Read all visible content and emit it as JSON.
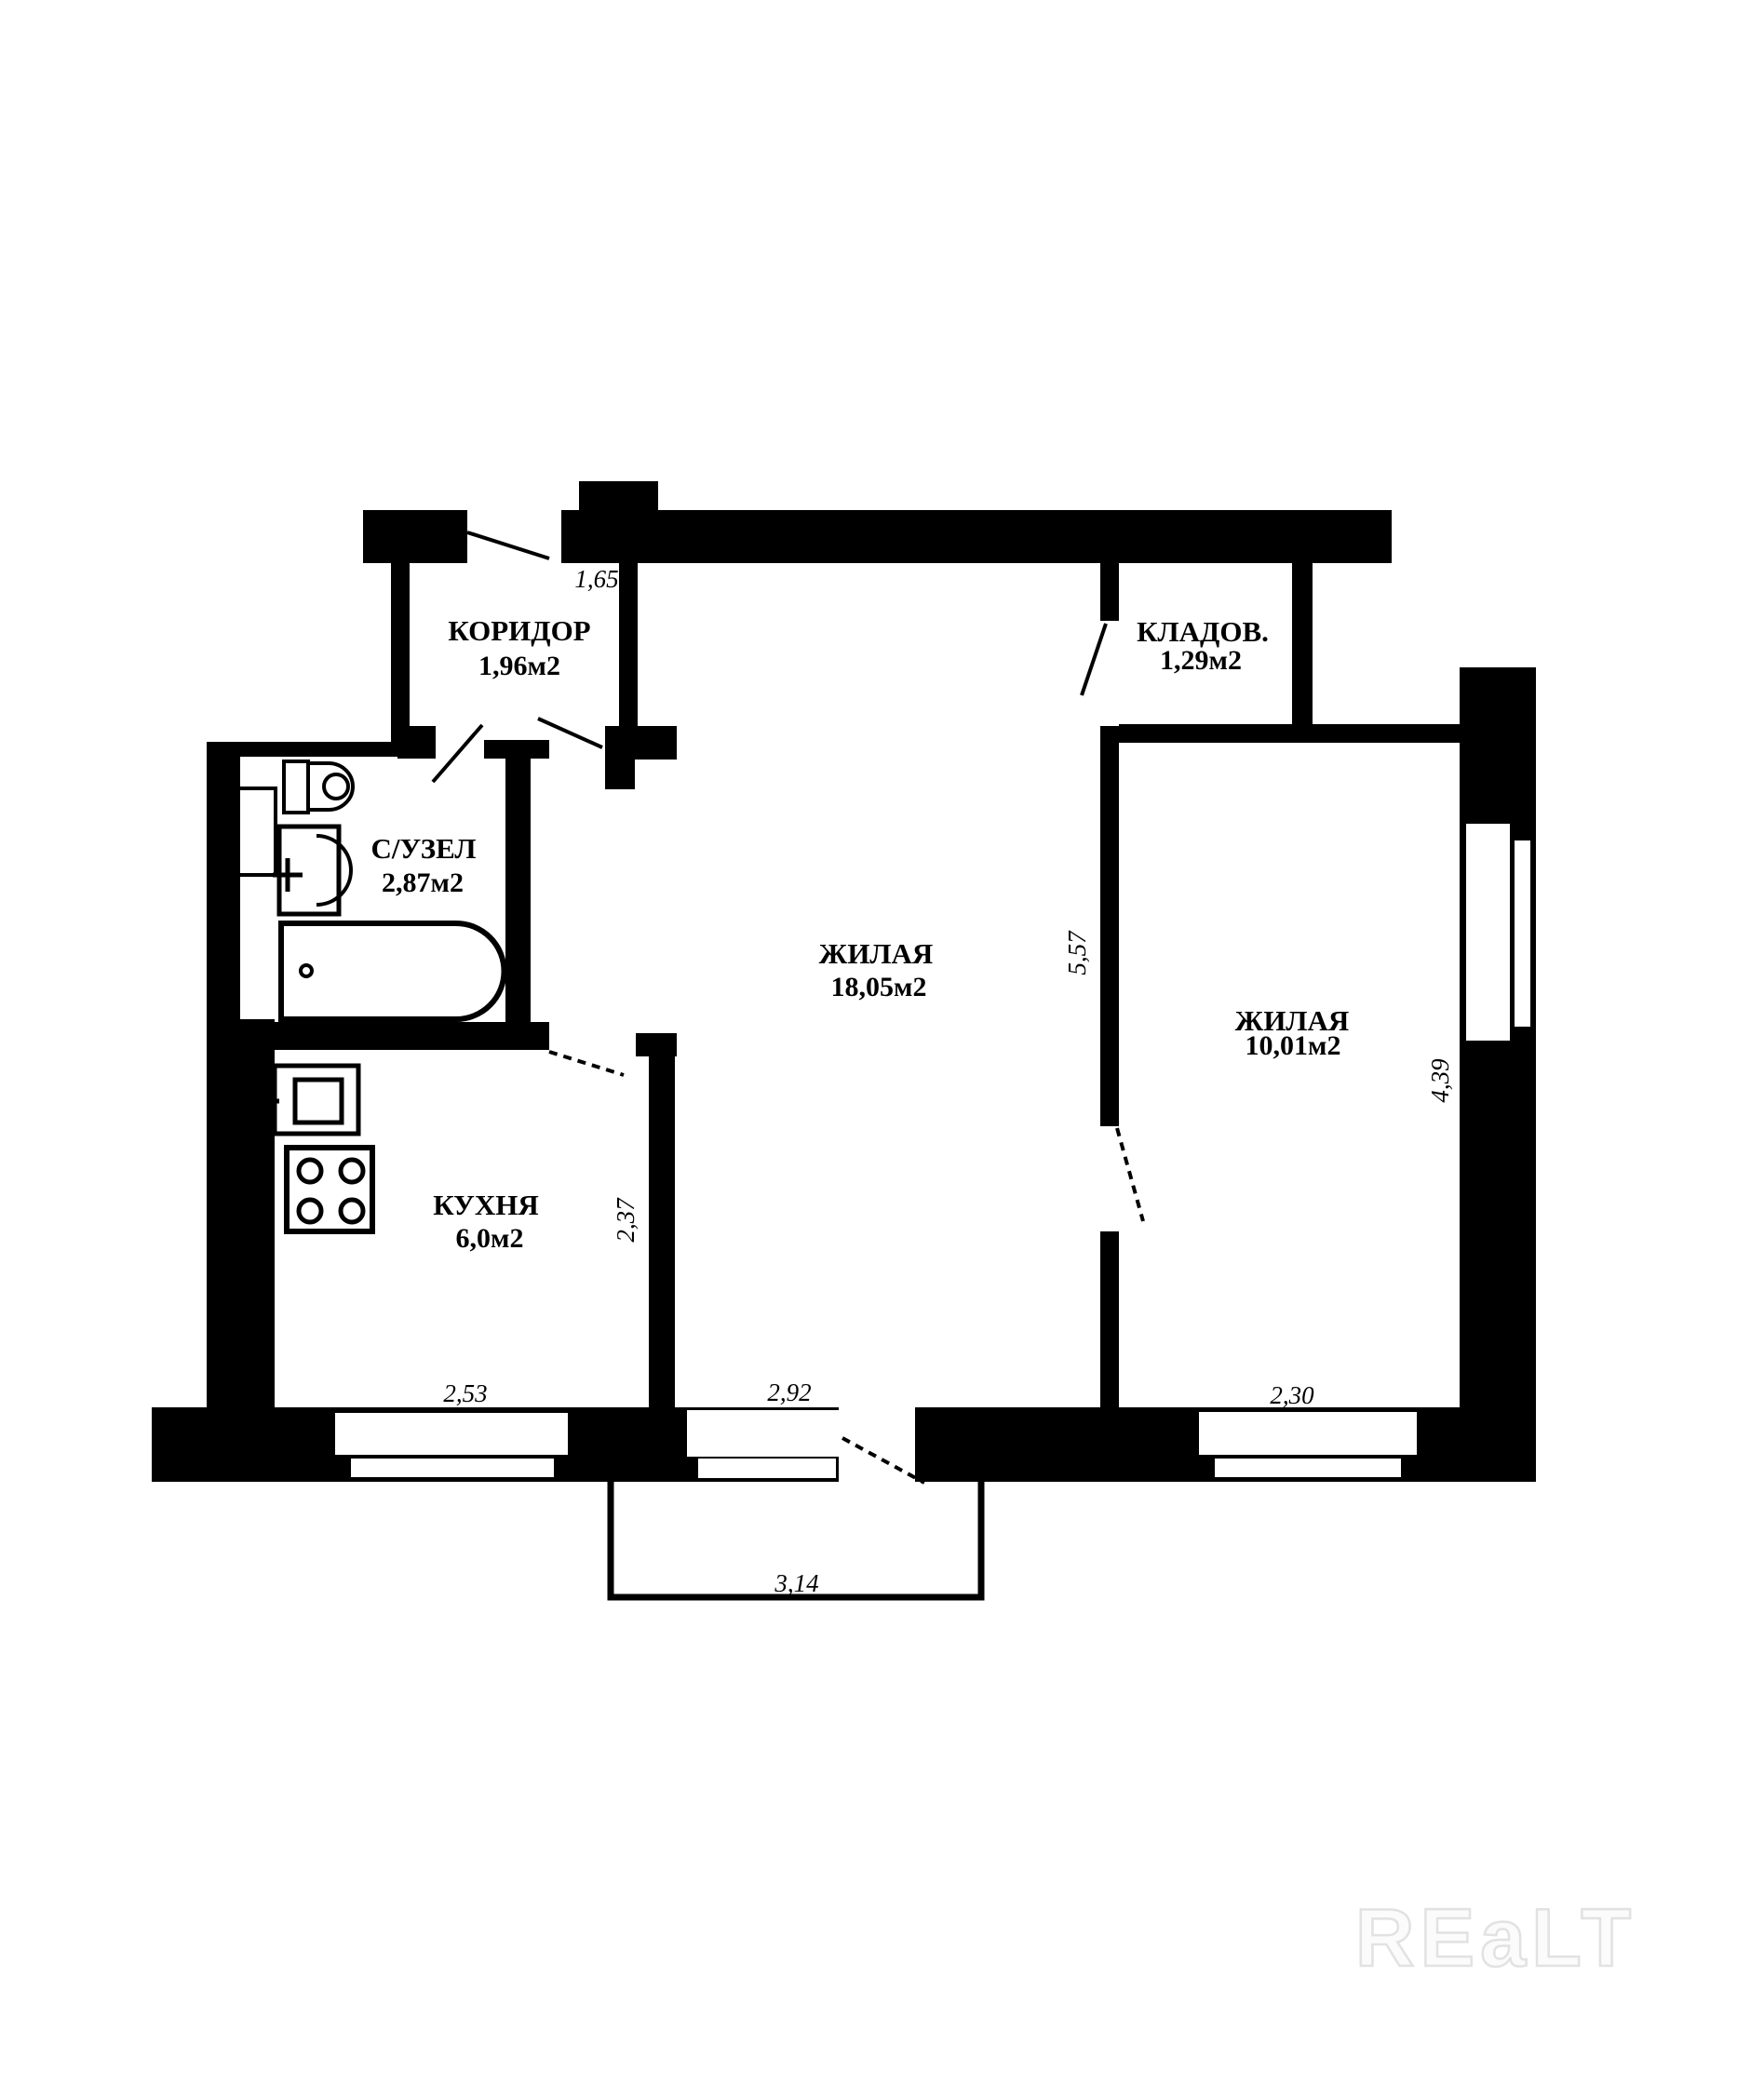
{
  "plan": {
    "rooms": {
      "corridor": {
        "label": "КОРИДОР",
        "area": "1,96м2"
      },
      "bathroom": {
        "label": "С/УЗЕЛ",
        "area": "2,87м2"
      },
      "kitchen": {
        "label": "КУХНЯ",
        "area": "6,0м2"
      },
      "living": {
        "label": "ЖИЛАЯ",
        "area": "18,05м2"
      },
      "storage": {
        "label": "КЛАДОВ.",
        "area": "1,29м2"
      },
      "bedroom": {
        "label": "ЖИЛАЯ",
        "area": "10,01м2"
      }
    },
    "dimensions": {
      "entry_width": "1,65",
      "kitchen_width": "2,53",
      "kitchen_depth": "2,37",
      "living_window_width": "2,92",
      "living_depth": "5,57",
      "bedroom_width": "2,30",
      "bedroom_depth": "4,39",
      "balcony_width": "3,14"
    },
    "watermark": "REaLT",
    "colors": {
      "wall": "#000000",
      "background": "#ffffff",
      "watermark_outline": "#e2e2e2"
    }
  }
}
